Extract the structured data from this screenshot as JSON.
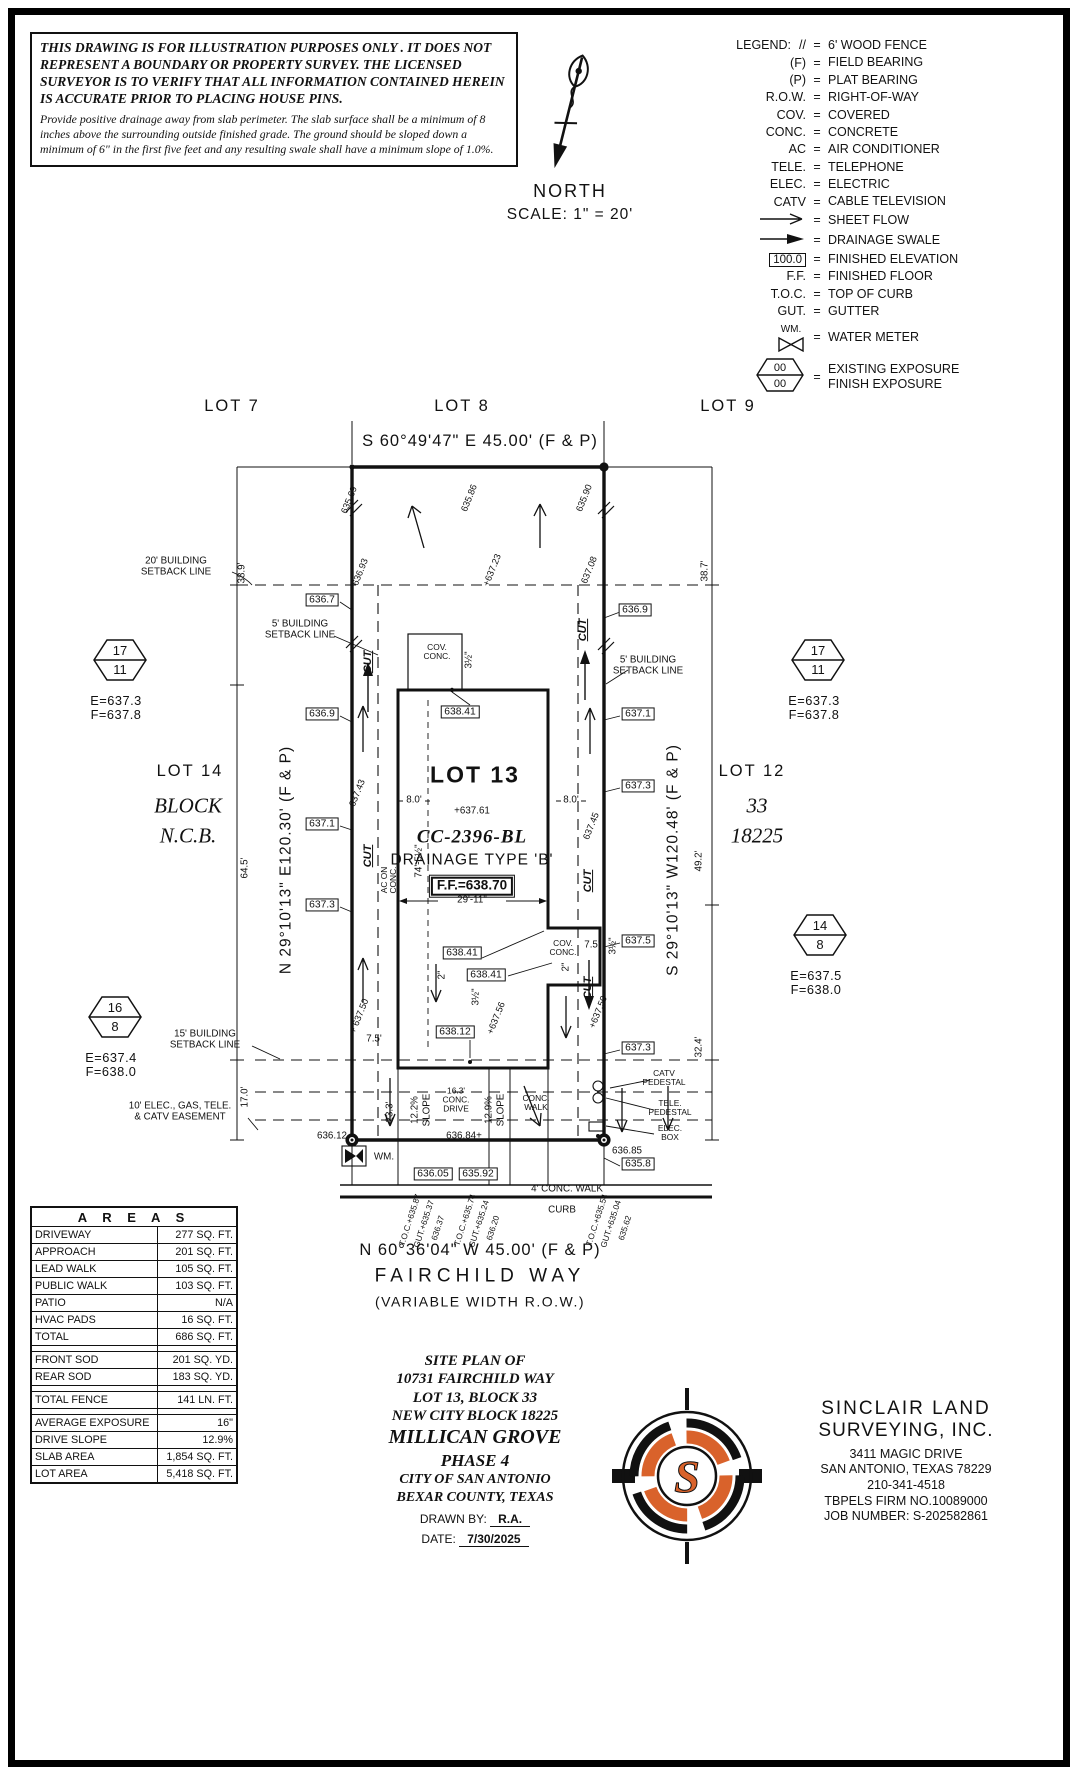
{
  "disclaimer": {
    "warning": "THIS DRAWING IS FOR ILLUSTRATION PURPOSES ONLY . IT DOES NOT REPRESENT A BOUNDARY OR PROPERTY SURVEY. THE LICENSED SURVEYOR IS TO VERIFY THAT ALL INFORMATION CONTAINED HEREIN IS ACCURATE PRIOR TO PLACING HOUSE PINS.",
    "note": "Provide positive drainage away from slab perimeter. The slab surface shall be a minimum of 8 inches above the surrounding outside finished grade. The ground should be sloped down a minimum of 6\" in the first five feet and any resulting swale shall have a minimum slope of 1.0%."
  },
  "north": {
    "label": "NORTH",
    "scale": "SCALE: 1\" = 20'"
  },
  "legend": {
    "title": "LEGEND:",
    "eq": "=",
    "items": [
      {
        "icon": "text",
        "key": "//",
        "value": "6' WOOD FENCE"
      },
      {
        "icon": "text",
        "key": "(F)",
        "value": "FIELD BEARING"
      },
      {
        "icon": "text",
        "key": "(P)",
        "value": "PLAT BEARING"
      },
      {
        "icon": "text",
        "key": "R.O.W.",
        "value": "RIGHT-OF-WAY"
      },
      {
        "icon": "text",
        "key": "COV.",
        "value": "COVERED"
      },
      {
        "icon": "text",
        "key": "CONC.",
        "value": "CONCRETE"
      },
      {
        "icon": "text",
        "key": "AC",
        "value": "AIR CONDITIONER"
      },
      {
        "icon": "text",
        "key": "TELE.",
        "value": "TELEPHONE"
      },
      {
        "icon": "text",
        "key": "ELEC.",
        "value": "ELECTRIC"
      },
      {
        "icon": "text",
        "key": "CATV",
        "value": "CABLE TELEVISION"
      },
      {
        "icon": "arrow-open",
        "key": "",
        "value": "SHEET FLOW"
      },
      {
        "icon": "arrow-solid",
        "key": "",
        "value": "DRAINAGE SWALE"
      },
      {
        "icon": "box",
        "key": "100.0",
        "value": "FINISHED ELEVATION"
      },
      {
        "icon": "text",
        "key": "F.F.",
        "value": "FINISHED FLOOR"
      },
      {
        "icon": "text",
        "key": "T.O.C.",
        "value": "TOP OF CURB"
      },
      {
        "icon": "text",
        "key": "GUT.",
        "value": "GUTTER"
      },
      {
        "icon": "wm",
        "key": "WM.",
        "value": "WATER METER"
      },
      {
        "icon": "hex",
        "key": "00|00",
        "value": "EXISTING EXPOSURE\nFINISH EXPOSURE"
      }
    ]
  },
  "plan": {
    "texts": {
      "lot7": "LOT 7",
      "lot8": "LOT 8",
      "lot9": "LOT 9",
      "bear_top": "S 60°49'47\" E 45.00' (F & P)",
      "bear_bottom": "N 60°36'04\" W 45.00' (F & P)",
      "bear_left": "N 29°10'13\" E120.30' (F & P)",
      "bear_right": "S 29°10'13\" W120.48' (F & P)",
      "street": "FAIRCHILD WAY",
      "row_note": "(VARIABLE WIDTH R.O.W.)",
      "lot14": "LOT 14",
      "block_word": "BLOCK",
      "ncb_word": "N.C.B.",
      "lot12": "LOT 12",
      "block_num": "33",
      "ncb_num": "18225",
      "lot13": "LOT 13",
      "spot_637_61": "+637.61",
      "cc_number": "CC-2396-BL",
      "drainage": "DRAINAGE TYPE 'B'",
      "ff": "F.F.=638.70",
      "sb20": "20' BUILDING\nSETBACK LINE",
      "sb5_left": "5' BUILDING\nSETBACK LINE",
      "sb5_right": "5' BUILDING\nSETBACK LINE",
      "sb15": "15' BUILDING\nSETBACK LINE",
      "easement": "10' ELEC., GAS, TELE.\n& CATV EASEMENT",
      "cov_conc_top": "COV.\nCONC.",
      "cov_conc_right": "COV.\nCONC.",
      "conc_walk": "CONC.\nWALK",
      "conc_drive": "16.3'\nCONC.\nDRIVE",
      "walk4": "4' CONC. WALK",
      "curb": "CURB",
      "dim_38_9": "38.9'",
      "dim_64_5": "64.5'",
      "dim_17_0": "17.0'",
      "dim_38_7": "38.7'",
      "dim_49_2": "49.2'",
      "dim_32_4": "32.4'",
      "dim_8_left": "8.0'",
      "dim_8_right": "8.0'",
      "dim_74": "74'-5½\"",
      "dim_29_11": "29'-11\"",
      "dim_7_5_right": "7.5'",
      "dim_7_5_left": "7.5'",
      "dim_23_3": "23.3'",
      "slope_12_2": "12.2%",
      "slope_12_2_w": "SLOPE",
      "slope_12_9": "12.9%",
      "slope_12_9_w": "SLOPE",
      "el_635_69": "635.69",
      "el_636_93": "636.93",
      "el_637_43": "637.43",
      "el_637_50_l": "+ 637.50",
      "el_635_86": "635.86",
      "el_637_23": "+637.23",
      "el_635_90": "635.90",
      "el_637_08": "637.08",
      "el_637_45": "637.45",
      "el_637_50_r": "+637.50",
      "el_637_56": "+637.56",
      "bx_636_7": "636.7",
      "bx_636_9_l": "636.9",
      "bx_637_1_l": "637.1",
      "bx_637_3_l": "637.3",
      "bx_636_9_r": "636.9",
      "bx_637_1_r": "637.1",
      "bx_637_3_r1": "637.3",
      "bx_637_5_r": "637.5",
      "bx_637_3_r2": "637.3",
      "bx_635_8": "635.8",
      "bx_638_41_a": "638.41",
      "bx_638_41_b": "638.41",
      "bx_638_41_c": "638.41",
      "bx_638_12": "638.12",
      "bx_636_05": "636.05",
      "bx_635_92": "635.92",
      "el_636_12": "636.12",
      "el_636_84": "636.84+",
      "el_636_85": "636.85",
      "wm": "WM.",
      "catv_ped": "CATV\nPEDESTAL",
      "tele_ped": "TELE.\nPEDESTAL",
      "elec_box": "ELEC.\nBOX",
      "cut1": "CUT",
      "cut2": "CUT",
      "cut3": "CUT",
      "cut4": "CUT",
      "cut5": "CUT",
      "ac_on": "AC ON\nCONC.",
      "in_3h_a": "3½\"",
      "in_3h_b": "3½\"",
      "in_3h_c": "3½\"",
      "in_2_a": "2\"",
      "in_2_b": "2\"",
      "toc1": "T.O.C.+635.87",
      "gut1": "GUT.+635.37",
      "g1": "636.37",
      "toc2": "T.O.C.+635.74",
      "gut2": "GUT.+635.24",
      "g2": "636.20",
      "toc3": "T.O.C.+635.54",
      "gut3": "GUT.+635.04",
      "g3": "635.62",
      "hx1_top": "17",
      "hx1_bot": "11",
      "hx1_e": "E=637.3",
      "hx1_f": "F=637.8",
      "hx2_top": "17",
      "hx2_bot": "11",
      "hx2_e": "E=637.3",
      "hx2_f": "F=637.8",
      "hx3_top": "14",
      "hx3_bot": "8",
      "hx3_e": "E=637.5",
      "hx3_f": "F=638.0",
      "hx4_top": "16",
      "hx4_bot": "8",
      "hx4_e": "E=637.4",
      "hx4_f": "F=638.0"
    }
  },
  "areas": {
    "title": "A R E A S",
    "rows": [
      {
        "label": "DRIVEWAY",
        "value": "277 SQ. FT."
      },
      {
        "label": "APPROACH",
        "value": "201 SQ. FT."
      },
      {
        "label": "LEAD WALK",
        "value": "105 SQ. FT."
      },
      {
        "label": "PUBLIC WALK",
        "value": "103 SQ. FT."
      },
      {
        "label": "PATIO",
        "value": "N/A"
      },
      {
        "label": "HVAC PADS",
        "value": "16 SQ. FT."
      },
      {
        "label": "TOTAL",
        "value": "686 SQ. FT."
      },
      {
        "spacer": true
      },
      {
        "label": "FRONT SOD",
        "value": "201 SQ. YD."
      },
      {
        "label": "REAR SOD",
        "value": "183 SQ. YD."
      },
      {
        "spacer": true
      },
      {
        "label": "TOTAL FENCE",
        "value": "141 LN. FT."
      },
      {
        "spacer": true
      },
      {
        "label": "AVERAGE EXPOSURE",
        "value": "16\""
      },
      {
        "label": "DRIVE SLOPE",
        "value": "12.9%"
      },
      {
        "label": "SLAB AREA",
        "value": "1,854 SQ. FT."
      },
      {
        "label": "LOT AREA",
        "value": "5,418 SQ. FT."
      }
    ]
  },
  "title_block": {
    "lines": [
      {
        "text": "SITE PLAN OF",
        "cls": "tb1"
      },
      {
        "text": "10731 FAIRCHILD WAY",
        "cls": "tb1"
      },
      {
        "text": "LOT 13, BLOCK 33",
        "cls": "tb1"
      },
      {
        "text": "NEW CITY BLOCK 18225",
        "cls": "tb1"
      },
      {
        "text": "MILLICAN GROVE",
        "cls": "tb2"
      },
      {
        "text": "PHASE 4",
        "cls": "tb2b"
      },
      {
        "text": "CITY OF SAN ANTONIO",
        "cls": "tb3"
      },
      {
        "text": "BEXAR COUNTY, TEXAS",
        "cls": "tb3"
      }
    ],
    "drawn_by_label": "DRAWN BY:",
    "drawn_by": "R.A.",
    "date_label": "DATE:",
    "date": "7/30/2025"
  },
  "firm": {
    "name1": "SINCLAIR LAND",
    "name2": "SURVEYING, INC.",
    "address1": "3411 MAGIC DRIVE",
    "address2": "SAN ANTONIO, TEXAS 78229",
    "phone": "210-341-4518",
    "tbpels": "TBPELS FIRM NO.10089000",
    "job": "JOB NUMBER: S-202582861",
    "accent": "#d9622b",
    "ink": "#111111"
  }
}
